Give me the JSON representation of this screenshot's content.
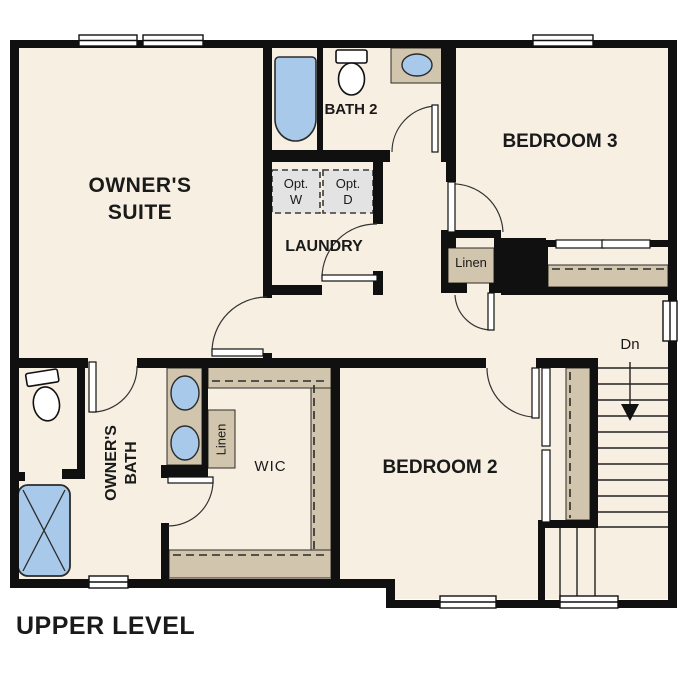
{
  "title": "UPPER LEVEL",
  "rooms": {
    "owners_suite": "OWNER'S SUITE",
    "owners_bath": "OWNER'S BATH",
    "bath2": "BATH 2",
    "laundry": "LAUNDRY",
    "bedroom3": "BEDROOM 3",
    "bedroom2": "BEDROOM 2",
    "wic": "WIC",
    "linen_upper": "Linen",
    "linen_lower": "Linen"
  },
  "annotations": {
    "stairs_direction": "Dn",
    "opt_washer": "Opt. W",
    "opt_dryer": "Opt. D"
  },
  "fixtures": [
    "bathtub",
    "toilet-bath2",
    "sink-bath2",
    "toilet-owners-bath",
    "double-vanity-sinks",
    "shower",
    "optional-washer",
    "optional-dryer",
    "wic-shelving",
    "bedroom2-closet",
    "bedroom3-closet",
    "stairs-down"
  ],
  "colors": {
    "wall": "#101010",
    "floor": "#f7efe1",
    "millwork_tan": "#d1c5ad",
    "fixture_blue": "#a8c9e9",
    "appliance_gray": "#e3e3e3",
    "outside": "#ffffff"
  }
}
